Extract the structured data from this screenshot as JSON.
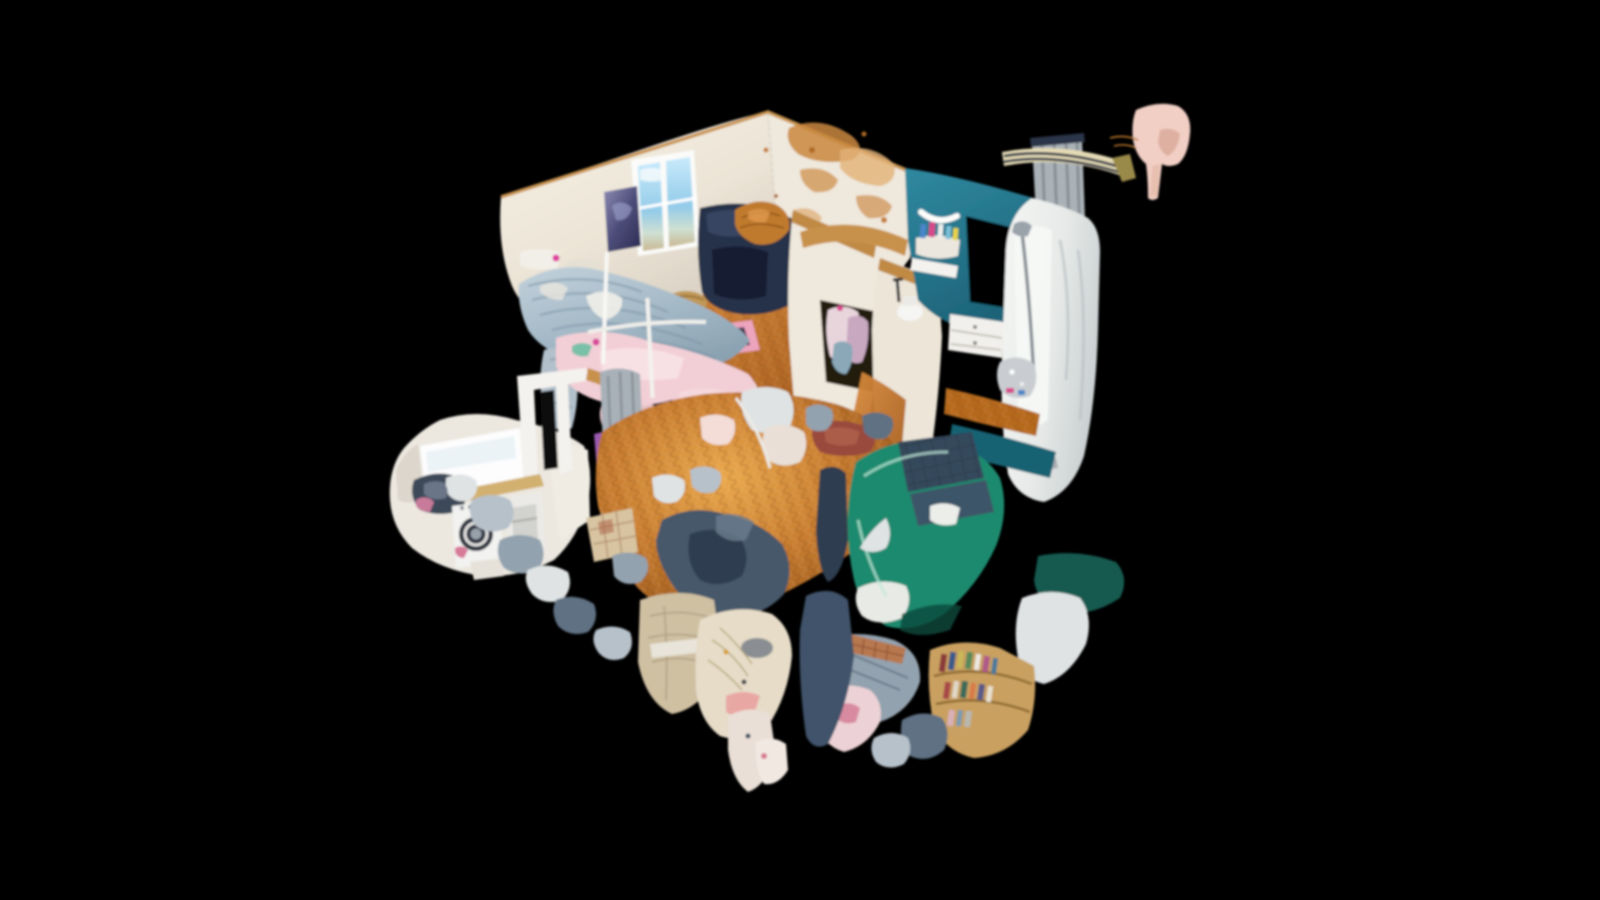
{
  "app": {
    "name": "3D virtual tour viewer",
    "view_mode": "dollhouse",
    "background": "#000000"
  },
  "viewport": {
    "width": 1600,
    "height": 900
  },
  "palette": {
    "background": "#000000",
    "wall_white": "#efe8dc",
    "wall_shadow": "#d9d1c3",
    "wall_damage": "#c9873e",
    "wood_cut_edge": "#c08a45",
    "window_frame": "#fbfbf9",
    "poster_nebula": "#54547e",
    "bed_duvet": "#a6bac7",
    "blanket_pink": "#f2cfd6",
    "wardrobe_navy": "#26304a",
    "wood_floor": "#c1722c",
    "wood_floor_light": "#e8a348",
    "teal_wall": "#27798d",
    "teal_floor": "#156273",
    "sofa_teal": "#1c8a6e",
    "cushion_navy": "#35495c",
    "shower_white": "#e9ebe8",
    "machine_white": "#f2f2f0",
    "machine_door": "#2e3440",
    "rug_pink": "#eda4bd",
    "rug_red": "#9a4a3c",
    "rail_cream": "#e6dcb6",
    "rail_navy": "#2a3548",
    "shelf_wood": "#c9a060",
    "fragment_pink": "#f2cfc4",
    "mat_beige": "#cfc0a2",
    "curtain_gray": "#aab2b8"
  },
  "scene": {
    "description": "Cutaway dollhouse 3D scan of a small apartment seen from above at an angle, floating on black",
    "rooms": [
      {
        "id": "bedroom",
        "features": [
          "window with sky",
          "galaxy poster",
          "striped duvet bed",
          "pink blanket",
          "navy wardrobe",
          "pink rug",
          "wicker basket",
          "parquet floor",
          "water-damaged wall patches"
        ]
      },
      {
        "id": "bathroom",
        "features": [
          "teal wall",
          "white crescent towel",
          "toiletry shelf",
          "dark opening",
          "shower enclosure",
          "white vanity drawers",
          "striped curtain rail",
          "gray curtain",
          "teal floor"
        ]
      },
      {
        "id": "hallway",
        "features": [
          "cut walls with wood top edges",
          "open closet with clothes",
          "toilet",
          "doorway beam"
        ]
      },
      {
        "id": "laundry",
        "features": [
          "bright window",
          "countertop",
          "washing machine with round door",
          "clothes pile",
          "second appliance"
        ]
      },
      {
        "id": "living_area",
        "features": [
          "teal sofa with navy cushions",
          "bookshelf with book spines",
          "red rug",
          "golden parquet floor",
          "beige mat",
          "round side table"
        ]
      }
    ],
    "artifacts": [
      "floating pink mesh fragment top right",
      "jagged scan boundary fragments",
      "black holes in mesh"
    ]
  }
}
